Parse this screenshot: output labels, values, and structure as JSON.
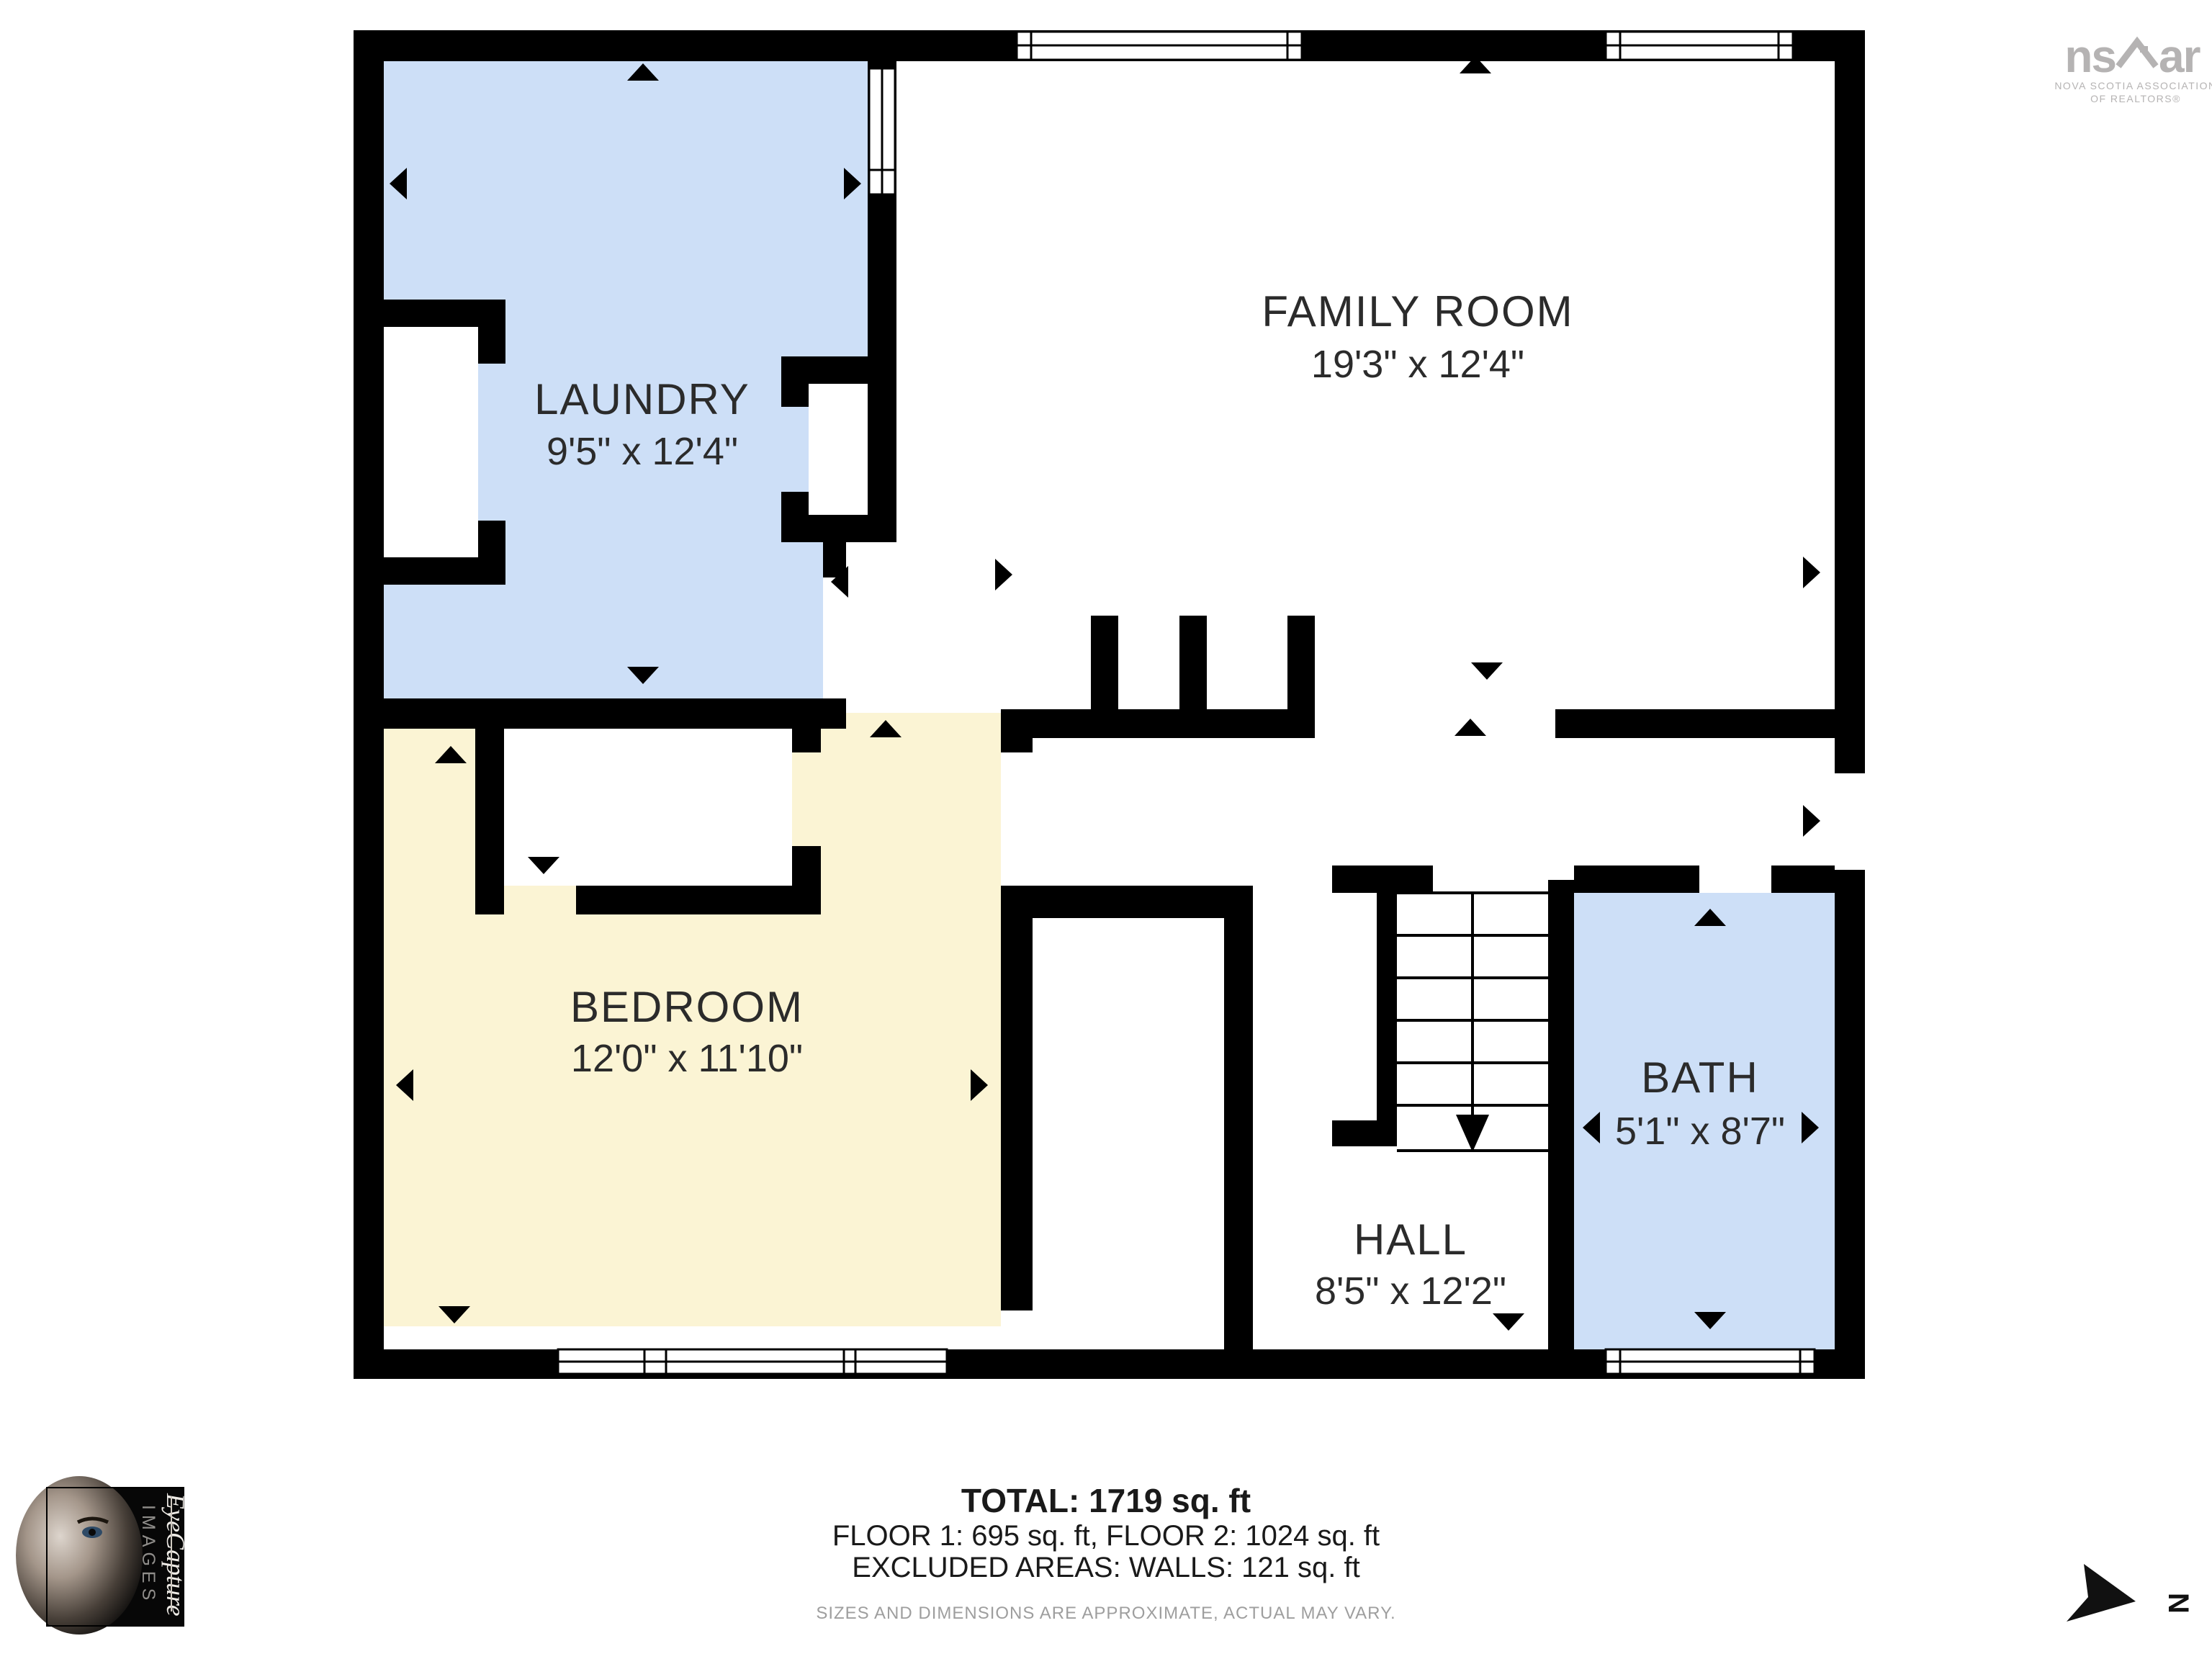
{
  "plan": {
    "rooms": [
      {
        "id": "laundry",
        "name": "LAUNDRY",
        "dims": "9'5\" x 12'4\""
      },
      {
        "id": "family-room",
        "name": "FAMILY ROOM",
        "dims": "19'3\" x 12'4\""
      },
      {
        "id": "bedroom",
        "name": "BEDROOM",
        "dims": "12'0\" x 11'10\""
      },
      {
        "id": "hall",
        "name": "HALL",
        "dims": "8'5\" x 12'2\""
      },
      {
        "id": "bath",
        "name": "BATH",
        "dims": "5'1\" x 8'7\""
      }
    ]
  },
  "summary": {
    "total": "TOTAL: 1719 sq. ft",
    "floors": "FLOOR 1: 695 sq. ft, FLOOR 2: 1024 sq. ft",
    "excluded": "EXCLUDED AREAS: WALLS: 121 sq. ft",
    "disclaimer": "SIZES AND DIMENSIONS ARE APPROXIMATE, ACTUAL MAY VARY."
  },
  "branding": {
    "realtor_logo": {
      "left": "ns",
      "right": "ar",
      "subtext1": "NOVA SCOTIA ASSOCIATION",
      "subtext2": "OF REALTORS®"
    },
    "photographer_logo": {
      "line1": "EyeCapture",
      "line2": "IMAGES"
    },
    "compass": {
      "label": "N"
    }
  },
  "colors": {
    "room_blue": "#cddff7",
    "room_yellow": "#fbf4d4",
    "wall": "#000000",
    "plan_bg": "#ffffff"
  }
}
